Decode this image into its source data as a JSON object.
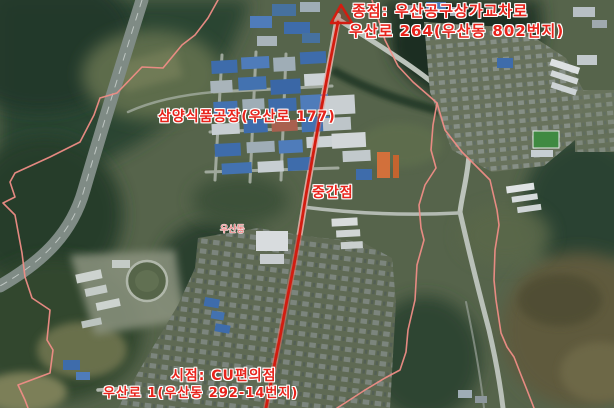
{
  "map": {
    "type": "satellite-route-map",
    "labels": {
      "destination": {
        "line1": "종점: 우산공구상가교차로",
        "line2": "우산로 264(우산동 802번지)"
      },
      "factory": "삼양식품공장(우산로 177)",
      "midpoint": "중간점",
      "district": "우산동",
      "start": {
        "line1": "시점: CU편의점",
        "line2": "우산로 1(우산동 292-14번지)"
      }
    },
    "icons": {
      "destination_marker": "triangle-up-arrowhead"
    },
    "colors": {
      "route": "#d31c10",
      "route_glow": "#ff7a6e",
      "boundary": "#ef8d86",
      "label_text": "#e8231b",
      "district_text": "#ee8585"
    }
  }
}
